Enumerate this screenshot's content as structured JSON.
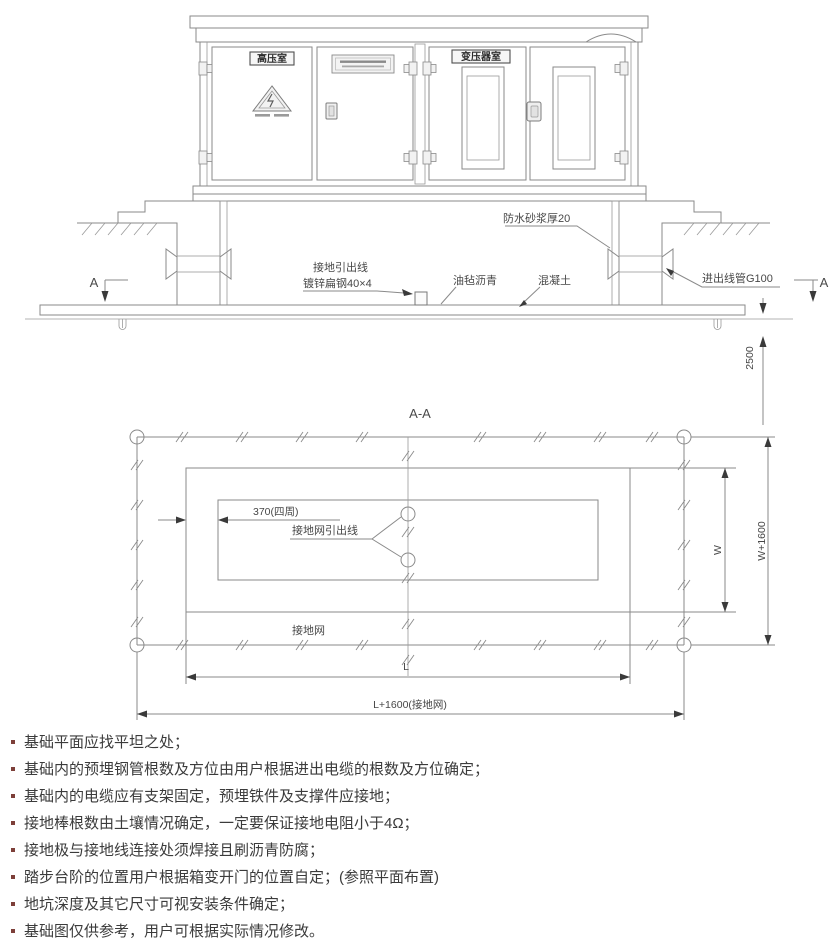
{
  "colors": {
    "line": "#8a8a8a",
    "text": "#474747",
    "note_text": "#3b3b3b",
    "bullet": "#7d3f39",
    "fill_light": "#ececec",
    "brick_fill": "#e6e6e6"
  },
  "elevation": {
    "hv_room_label": "高压室",
    "transformer_room_label": "变压器室",
    "waterproof_label": "防水砂浆厚20",
    "ground_lead_line1": "接地引出线",
    "ground_lead_line2": "镀锌扁钢40×4",
    "asphalt_felt_label": "油毡沥青",
    "concrete_label": "混凝土",
    "conduit_label": "进出线管G100",
    "section_marker_left": "A",
    "section_marker_right": "A",
    "depth_dim": "2500"
  },
  "plan": {
    "title": "A-A",
    "wall_thickness_dim": "370(四周)",
    "grid_lead_label": "接地网引出线",
    "grid_label": "接地网",
    "dim_l": "L",
    "dim_l_outer": "L+1600(接地网)",
    "dim_w": "W",
    "dim_w_outer": "W+1600"
  },
  "notes": {
    "items": [
      "基础平面应找平坦之处；",
      "基础内的预埋钢管根数及方位由用户根据进出电缆的根数及方位确定；",
      "基础内的电缆应有支架固定，预埋铁件及支撑件应接地；",
      "接地棒根数由土壤情况确定，一定要保证接地电阻小于4Ω；",
      "接地极与接地线连接处须焊接且刷沥青防腐；",
      "踏步台阶的位置用户根据箱变开门的位置自定；(参照平面布置)",
      "地坑深度及其它尺寸可视安装条件确定；",
      "基础图仅供参考，用户可根据实际情况修改。"
    ]
  }
}
